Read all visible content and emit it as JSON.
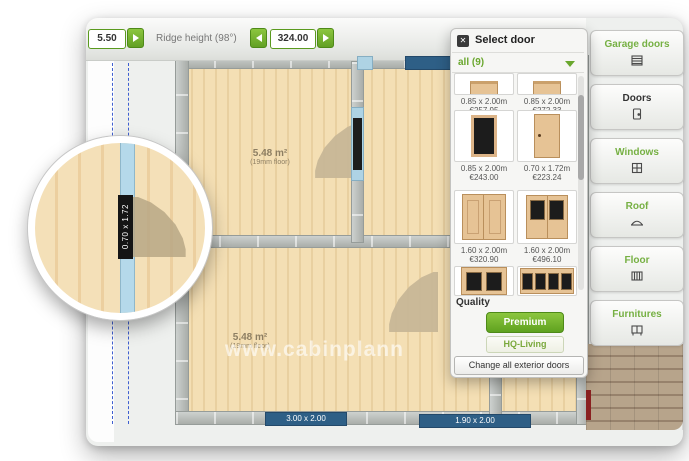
{
  "toolbar": {
    "left_value": "5.50",
    "ridge_label": "Ridge height (98°)",
    "ridge_value": "324.00"
  },
  "plan": {
    "rooms": [
      {
        "area": "5.48 m²",
        "floor_note": "(19mm floor)"
      },
      {
        "area": "5.48 m²",
        "floor_note": "(19mm floor)"
      }
    ],
    "magnifier_door_size": "0.70 x 1.72",
    "bottom_dims": [
      "3.00 x 2.00",
      "1.90 x 2.00"
    ],
    "watermark": "www.cabinplann"
  },
  "door_panel": {
    "title": "Select door",
    "close_icon": "✕",
    "filter_label": "all (9)",
    "items": [
      {
        "size": "0.85 x 2.00m",
        "price": "€257.95"
      },
      {
        "size": "0.85 x 2.00m",
        "price": "€272.33"
      },
      {
        "size": "0.85 x 2.00m",
        "price": "€243.00"
      },
      {
        "size": "0.70 x 1.72m",
        "price": "€223.24"
      },
      {
        "size": "1.60 x 2.00m",
        "price": "€320.90"
      },
      {
        "size": "1.60 x 2.00m",
        "price": "€496.10"
      }
    ],
    "quality_label": "Quality",
    "premium_button": "Premium",
    "hq_button": "HQ-Living",
    "change_button": "Change all exterior doors"
  },
  "sidebar": {
    "items": [
      {
        "label": "Garage doors"
      },
      {
        "label": "Doors"
      },
      {
        "label": "Windows"
      },
      {
        "label": "Roof"
      },
      {
        "label": "Floor"
      },
      {
        "label": "Furnitures"
      }
    ]
  },
  "colors": {
    "accent_green": "#76b043",
    "button_green": "#7cb82f",
    "wall_gray": "#b8bcba",
    "opening_blue": "#aed3e4",
    "dim_badge_blue": "#2e5f86",
    "wood_light": "#f3ddb3",
    "deck_brown": "#ac9a82"
  }
}
